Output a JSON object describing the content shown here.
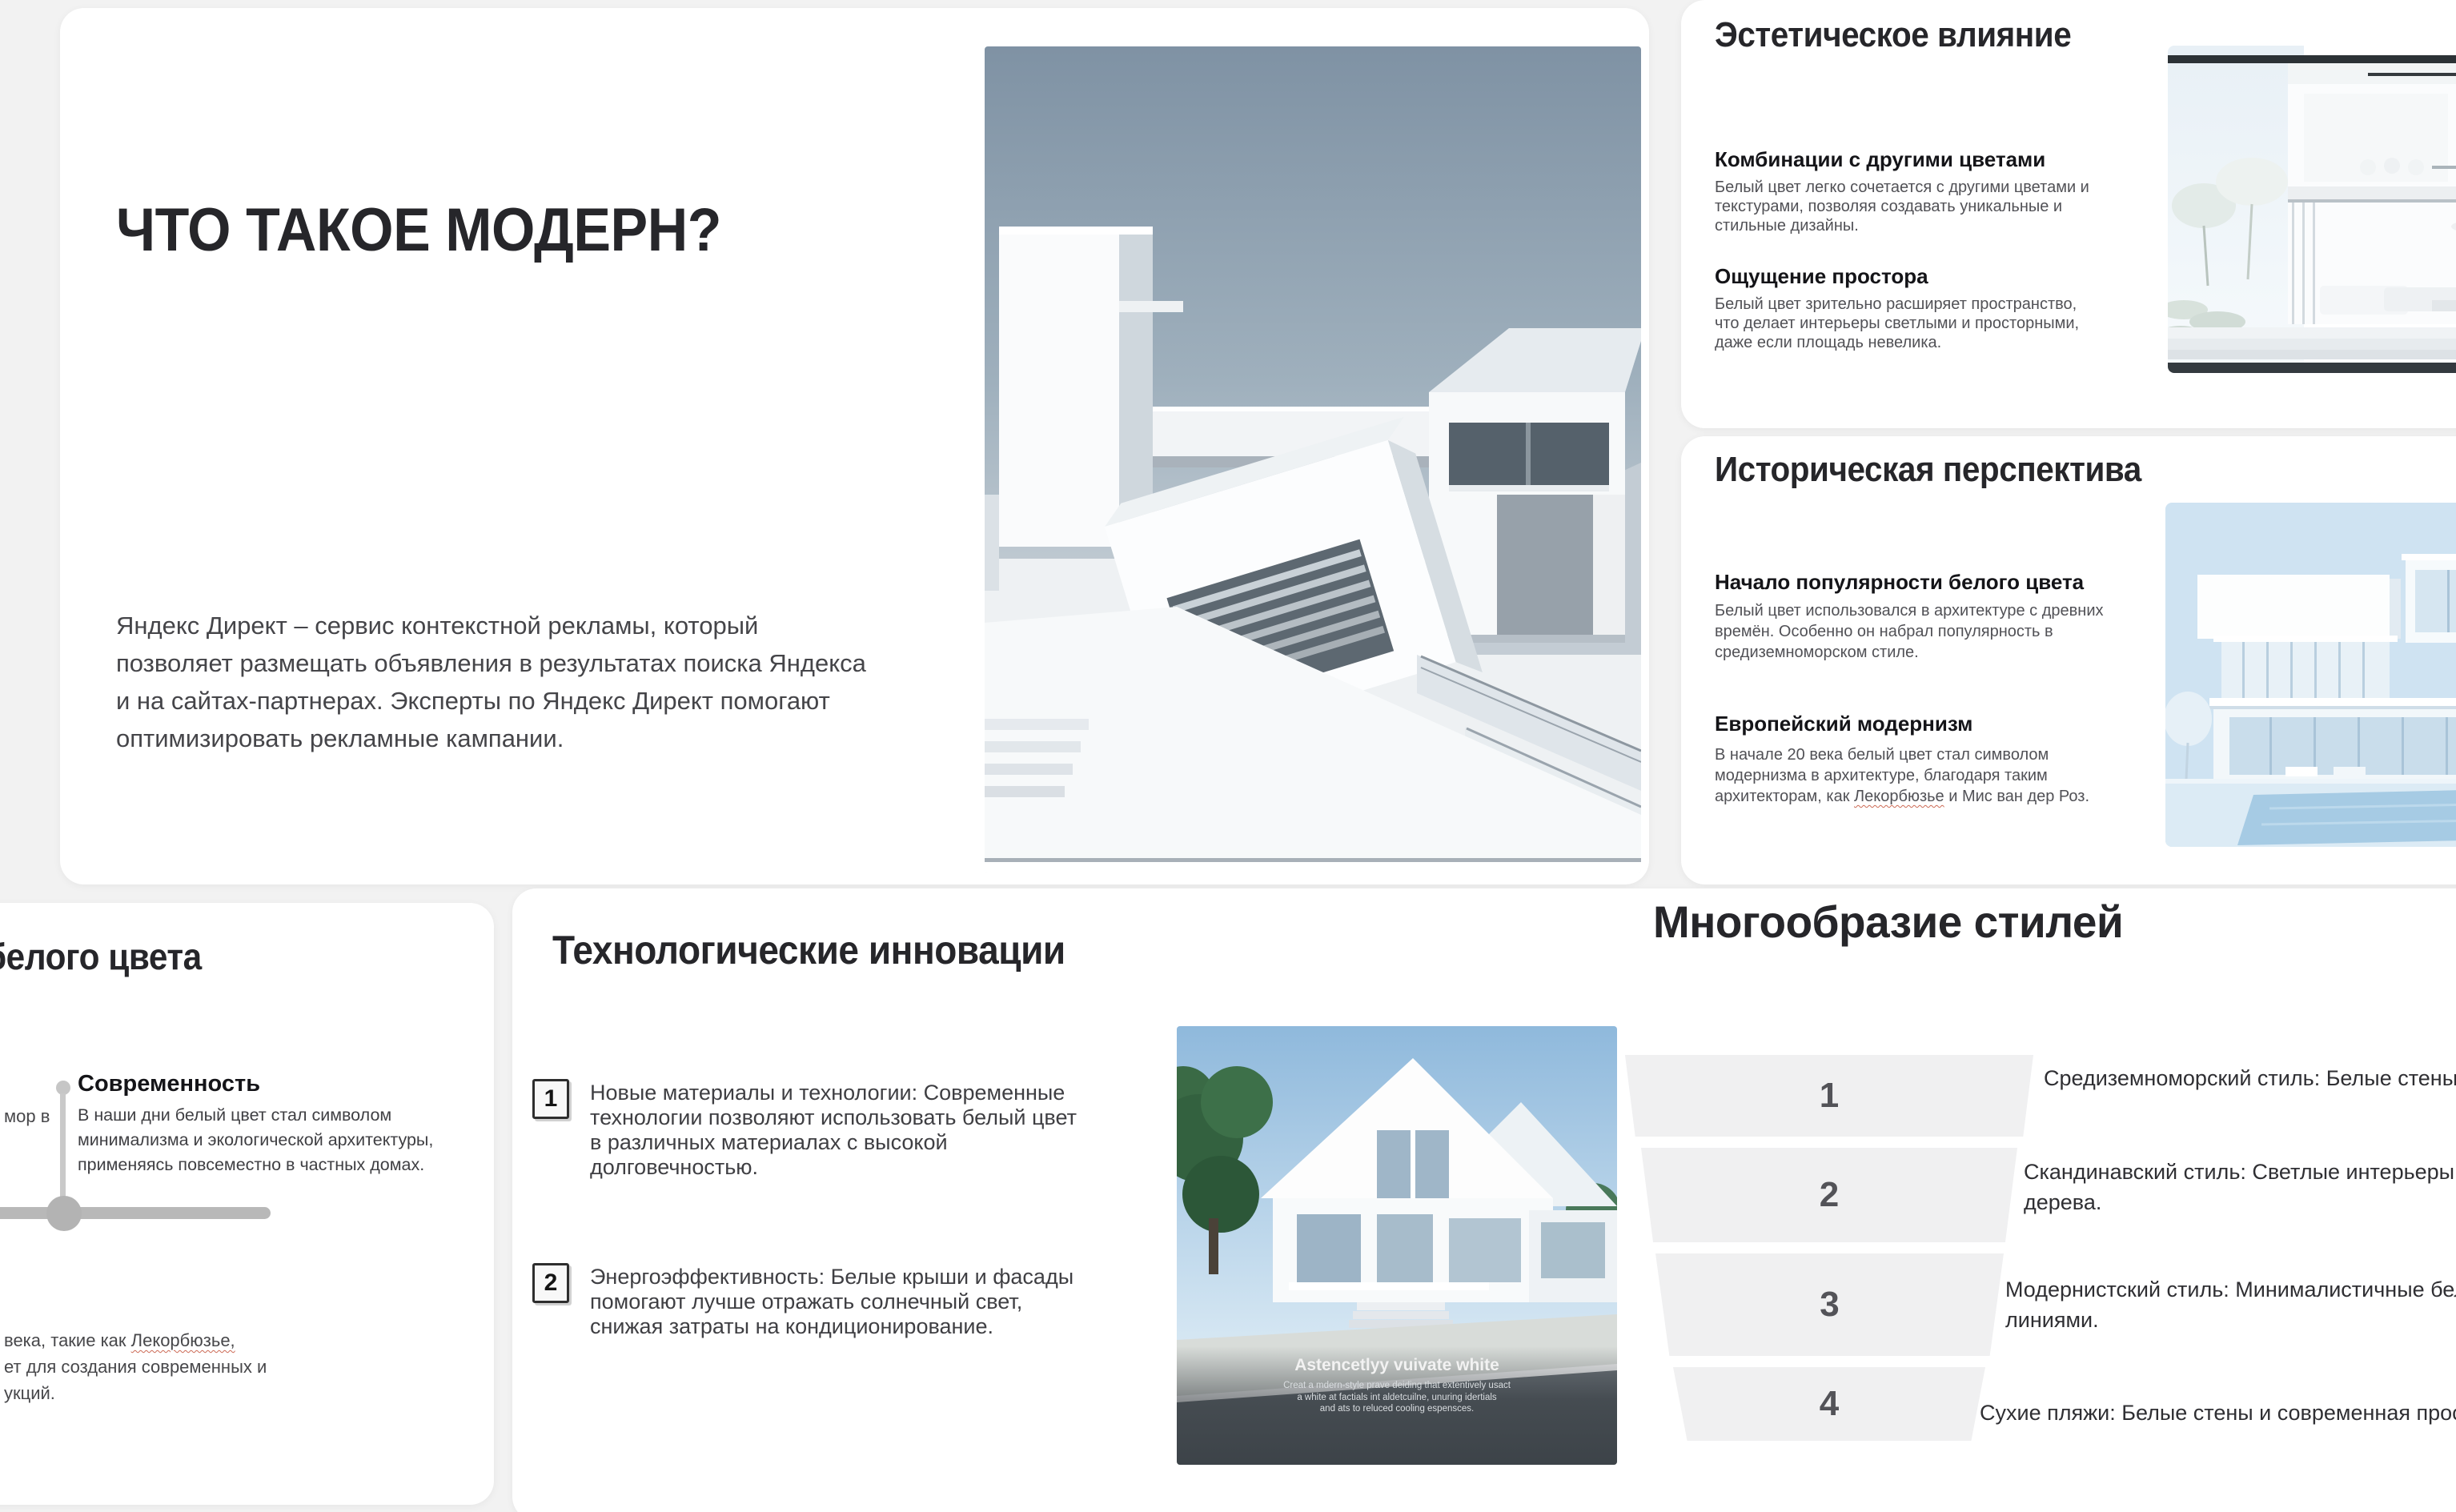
{
  "colors": {
    "canvas_bg": "#f2f2f2",
    "card_bg": "#ffffff",
    "heading": "#26262a",
    "body_text": "#515156",
    "timeline_gray": "#bdbdbd",
    "funnel_fill": "#f0f0f1",
    "spellcheck_underline": "#cc6a55"
  },
  "slide_main": {
    "title": "ЧТО ТАКОЕ МОДЕРН?",
    "body": "Яндекс Директ – сервис контекстной рекламы, который позволяет размещать объявления в результатах поиска Яндекса и на сайтах-партнерах. Эксперты по Яндекс Директ помогают оптимизировать рекламные кампании.",
    "image_alt": "white-geometric-modern-architecture-render"
  },
  "slide_aesthetic": {
    "title": "Эстетическое влияние",
    "sections": [
      {
        "heading": "Комбинации с другими цветами",
        "text": "Белый цвет легко сочетается с другими цветами и текстурами, позволяя создавать уникальные и стильные дизайны."
      },
      {
        "heading": "Ощущение простора",
        "text": "Белый цвет зрительно расширяет пространство, что делает интерьеры светлыми и просторными, даже если площадь невелика."
      }
    ],
    "image_alt": "white-interior-two-story-house"
  },
  "slide_history": {
    "title": "Историческая перспектива",
    "sections": [
      {
        "heading": "Начало популярности белого цвета",
        "text": "Белый цвет использовался в архитектуре с древних времён. Особенно он набрал популярность в средиземноморском стиле."
      },
      {
        "heading": "Европейский модернизм",
        "text_before": "В начале 20 века белый цвет стал символом модернизма в архитектуре, благодаря таким архитекторам, как ",
        "link_word": "Лекорбюзье",
        "text_after": " и Мис ван дер Роз."
      }
    ],
    "image_alt": "white-modern-villa-with-pool"
  },
  "slide_timeline": {
    "title_fragment": "белого цвета",
    "left_fragment": "мор в",
    "item": {
      "heading": "Современность",
      "text": "В наши дни белый цвет стал символом минимализма и экологической архитектуры, применяясь повсеместно в частных домах."
    },
    "fragments": {
      "before": "века, такие как ",
      "link": "Лекорбюзье,",
      "line2": "ет для создания современных и",
      "line3": "укций."
    }
  },
  "slide_tech": {
    "title": "Технологические инновации",
    "items": [
      {
        "number": "1",
        "text": "Новые материалы и технологии: Современные технологии позволяют использовать белый цвет в различных материалах с высокой долговечностью."
      },
      {
        "number": "2",
        "text": "Энергоэффективность: Белые крыши и фасады помогают лучше отражать солнечный свет, снижая затраты на кондиционирование."
      }
    ],
    "caption": {
      "title": "Astencetlyy vuivate white",
      "lines": [
        "Creat a mdern-style prave deiding  that extentively usact",
        "a white at factials int aldetcuilne, unuring idertials",
        "and ats to reluced cooling espensces."
      ]
    },
    "image_alt": "white-gable-modern-house"
  },
  "slide_styles": {
    "title": "Многообразие стилей",
    "items": [
      {
        "number": "1",
        "lines": [
          "Средиземноморский стиль: Белые стены и"
        ]
      },
      {
        "number": "2",
        "lines": [
          "Скандинавский стиль: Светлые интерьеры и",
          "дерева."
        ]
      },
      {
        "number": "3",
        "lines": [
          "Модернистский стиль: Минималистичные бель",
          "линиями."
        ]
      },
      {
        "number": "4",
        "lines": [
          "Сухие пляжи: Белые стены и современная просто"
        ]
      }
    ]
  }
}
